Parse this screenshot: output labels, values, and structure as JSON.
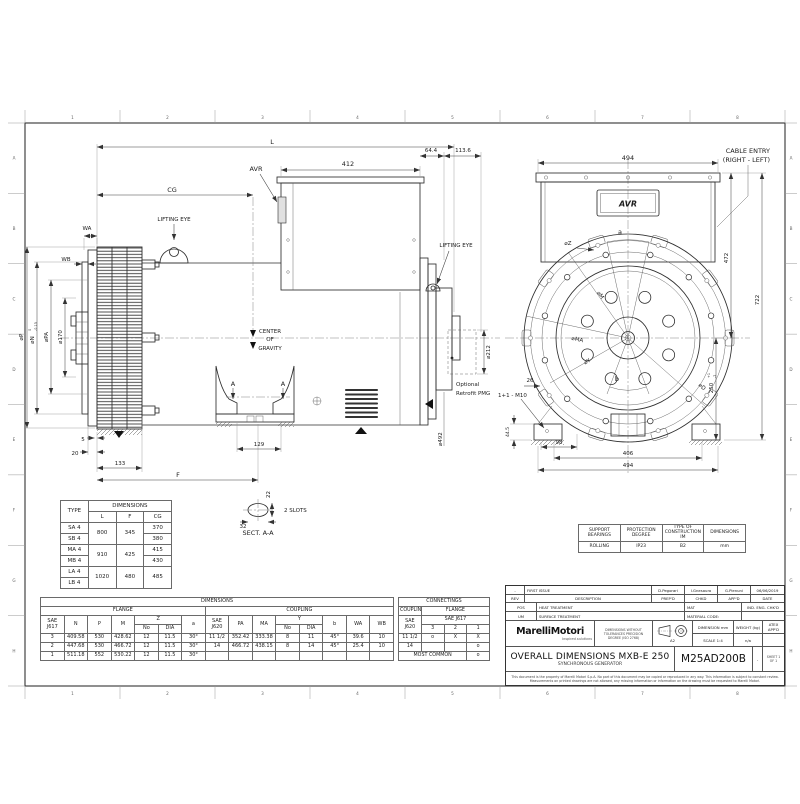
{
  "frame": {
    "cols": [
      "1",
      "2",
      "3",
      "4",
      "5",
      "6",
      "7",
      "8"
    ],
    "rows": [
      "A",
      "B",
      "C",
      "D",
      "E",
      "F",
      "G",
      "H"
    ]
  },
  "dims_labels": {
    "L": "L",
    "CG": "CG",
    "avr_side": "AVR",
    "d412": "412",
    "d64": "64.4",
    "d113": "113.6",
    "lift_l": "LIFTING EYE",
    "lift_r": "LIFTING EYE",
    "wa": "WA",
    "wb": "WB",
    "dp": "⌀P",
    "dn": "⌀N",
    "dn0": "0",
    "dn013": "-0.13",
    "dpa": "⌀PA",
    "d170": "⌀170",
    "d5": "5",
    "d20": "20",
    "d133": "133",
    "F": "F",
    "d129": "129",
    "cog1": "CENTER",
    "cog2": "OF",
    "cog3": "GRAVITY",
    "A": "A",
    "d492": "⌀492",
    "d212": "⌀212",
    "pmg1": "Optional",
    "pmg2": "Retrofit PMG",
    "d22": "22",
    "d32": "32",
    "slots": "2 SLOTS",
    "sect": "SECT.  A-A",
    "d494t": "494",
    "avr_end": "AVR",
    "a": "a",
    "dz": "⌀Z",
    "dm": "⌀M",
    "dma": "⌀MA",
    "dy": "⌀Y",
    "b": "b",
    "dd": "⌀D",
    "d26": "26",
    "m10": "1+1 - M10",
    "d445": "44.5",
    "d98": "98",
    "d406": "406",
    "d494b": "494",
    "d472": "472",
    "d722": "722",
    "d250": "250",
    "d250a": "+1",
    "d250b": "-2",
    "cable1": "CABLE ENTRY",
    "cable2": "(RIGHT - LEFT)"
  },
  "tables": {
    "type": {
      "name": "type-table",
      "rows": [
        [
          {
            "t": "TYPE",
            "r": 2
          },
          {
            "t": "DIMENSIONS",
            "c": 3
          }
        ],
        [
          "L",
          "F",
          "CG"
        ],
        [
          "SA 4",
          {
            "t": "800",
            "r": 2
          },
          {
            "t": "345",
            "r": 2
          },
          "370"
        ],
        [
          "SB 4",
          "380"
        ],
        [
          "MA 4",
          {
            "t": "910",
            "r": 2
          },
          {
            "t": "425",
            "r": 2
          },
          "415"
        ],
        [
          "MB 4",
          "430"
        ],
        [
          "LA 4",
          {
            "t": "1020",
            "r": 2
          },
          {
            "t": "480",
            "r": 2
          },
          {
            "t": "485",
            "r": 2
          }
        ],
        [
          "LB 4"
        ]
      ]
    },
    "dims": {
      "name": "dims-table",
      "rows": [
        [
          {
            "t": "DIMENSIONS",
            "c": 15
          }
        ],
        [
          {
            "t": "FLANGE",
            "c": 7
          },
          {
            "t": "COUPLING",
            "c": 8
          }
        ],
        [
          {
            "t": "SAE J617",
            "r": 2
          },
          {
            "t": "N",
            "r": 2
          },
          {
            "t": "P",
            "r": 2
          },
          {
            "t": "M",
            "r": 2
          },
          {
            "t": "Z",
            "c": 2
          },
          {
            "t": "a",
            "r": 2
          },
          {
            "t": "SAE J620",
            "r": 2
          },
          {
            "t": "PA",
            "r": 2
          },
          {
            "t": "MA",
            "r": 2
          },
          {
            "t": "Y",
            "c": 2
          },
          {
            "t": "b",
            "r": 2
          },
          {
            "t": "WA",
            "r": 2
          },
          {
            "t": "WB",
            "r": 2
          }
        ],
        [
          "No",
          "DIA",
          "No",
          "DIA"
        ],
        [
          "3",
          "409.58",
          "530",
          "428.62",
          "12",
          "11.5",
          "30°",
          "11 1/2",
          "352.42",
          "333.38",
          "8",
          "11",
          "45°",
          "39.6",
          "10"
        ],
        [
          "2",
          "447.68",
          "530",
          "466.72",
          "12",
          "11.5",
          "30°",
          "14",
          "466.72",
          "438.15",
          "8",
          "14",
          "45°",
          "25.4",
          "10"
        ],
        [
          "1",
          "511.18",
          "552",
          "530.22",
          "12",
          "11.5",
          "30°",
          "",
          "",
          "",
          "",
          "",
          "",
          "",
          ""
        ]
      ]
    },
    "connectings": {
      "name": "conn-table",
      "rows": [
        [
          {
            "t": "CONNECTINGS",
            "c": 4
          }
        ],
        [
          {
            "t": "COUPLING"
          },
          {
            "t": "FLANGE",
            "c": 3
          }
        ],
        [
          {
            "t": "SAE J620",
            "r": 2
          },
          {
            "t": "SAE J617",
            "c": 3
          }
        ],
        [
          "3",
          "2",
          "1"
        ],
        [
          "11 1/2",
          "o",
          "X",
          "X"
        ],
        [
          "14",
          "",
          "",
          "o"
        ],
        [
          {
            "t": "MOST COMMON",
            "c": 3
          },
          "o"
        ]
      ]
    },
    "bearings": {
      "name": "bear-table",
      "rows": [
        [
          "SUPPORT BEARINGS",
          "PROTECTION DEGREE",
          "TYPE OF CONSTRUCTION IM",
          "DIMENSIONS"
        ],
        [
          "ROLLING",
          "IP23",
          "B2",
          "mm"
        ]
      ]
    }
  },
  "titleblock": {
    "rev_mark": "-",
    "rev_desc": "FIRST ISSUE",
    "prep_name": "D.Pegorari",
    "chk_name": "I.Gnesauro",
    "app_name": "G.Pienuni",
    "date_val": "06/06/2019",
    "h_rev": "REV",
    "h_desc": "DESCRIPTION",
    "h_prep": "PREP'D",
    "h_chk": "CHKD",
    "h_app": "APP'D",
    "h_date": "DATE",
    "l_pos": "POS",
    "h_heat": "HEAT TREATMENT",
    "h_mat": "MAT",
    "h_indeng": "IND. ENG. CHK'D",
    "l_um": "UM",
    "h_surface": "SURFACE TREATMENT",
    "h_matcode": "MATERIAL CODE:",
    "logo": "MarelliMotori",
    "logo_sub": "Inspired solutions",
    "tol1": "DIMENSIONS WITHOUT",
    "tol2": "TOLERANCES PRECISION",
    "tol3": "DEGREE (ISO 2768)",
    "size": "A2",
    "h_dimension": "DIMENSION mm",
    "h_scale": "SCALE",
    "scale_val": "1:4",
    "h_weight": "WEIGHT (kg)",
    "weight_val": "n/a",
    "h_atex": "ATEX APP'D",
    "title1": "OVERALL DIMENSIONS MXB-E 250",
    "title2": "SYNCHRONOUS GENERATOR",
    "code": "M25AD200B",
    "code_rev": "-",
    "sheet1": "SHEET 1",
    "sheet2": "OF 1",
    "disc1": "This document is the property of Marelli Motori S.p.A. No part of this document may be copied or reproduced in any way. This information is subject to constant review.",
    "disc2": "Measurements on printed drawings are not allowed, any missing information or information on the drawing must be requested to Marelli Motori."
  }
}
